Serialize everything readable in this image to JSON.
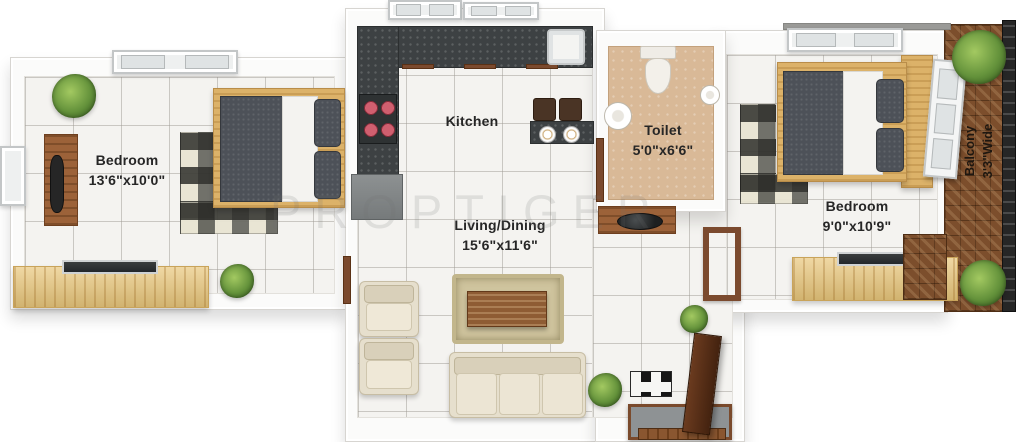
{
  "watermark": "PROPTIGER",
  "rooms": {
    "bedroom_left": {
      "name": "Bedroom",
      "dims": "13'6\"x10'0\""
    },
    "kitchen": {
      "name": "Kitchen"
    },
    "toilet": {
      "name": "Toilet",
      "dims": "5'0\"x6'6\""
    },
    "living_dining": {
      "name": "Living/Dining",
      "dims": "15'6\"x11'6\""
    },
    "bedroom_right": {
      "name": "Bedroom",
      "dims": "9'0\"x10'9\""
    },
    "balcony": {
      "name": "Balcony",
      "dims": "3'3\"Wide"
    }
  },
  "colors": {
    "kitchen_counter": "#3d4143",
    "toilet_floor": "#d9b997",
    "balcony_floor": "#7c4e2c",
    "light_wood": "#e9c77c",
    "bed_fabric": "#4d5158",
    "sofa_cream": "#e6dfcd",
    "label_text": "#262626"
  }
}
